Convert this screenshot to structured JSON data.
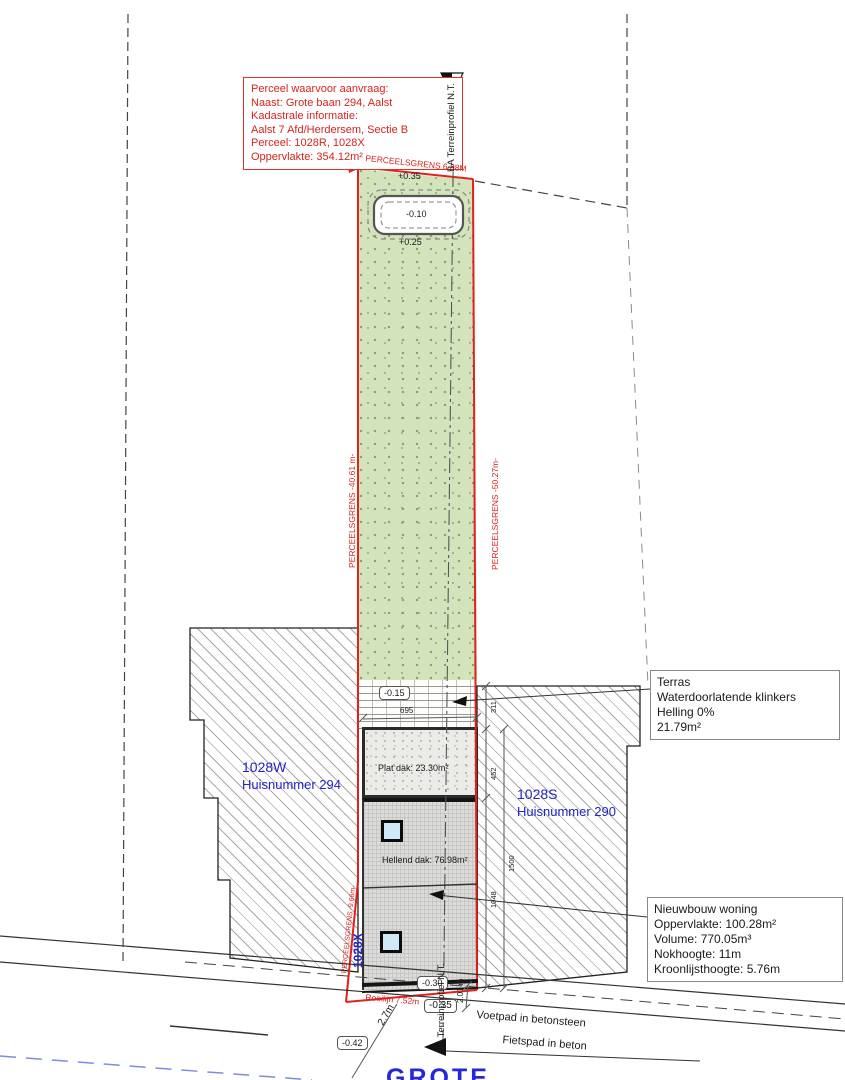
{
  "colors": {
    "boundary_red": "#e3201a",
    "label_blue": "#2222cc",
    "grass_green": "#d3e4bd",
    "street_dash_blue": "#7c8ce0"
  },
  "info_box": {
    "lines": [
      "Perceel waarvoor aanvraag:",
      "Naast: Grote baan 294, Aalst",
      "Kadastrale informatie:",
      "Aalst 7 Afd/Herdersem, Sectie B",
      "Perceel: 1028R, 1028X",
      "Oppervlakte: 354.12m²"
    ]
  },
  "terras_box": {
    "lines": [
      "Terras",
      "Waterdoorlatende klinkers",
      "Helling 0%",
      "21.79m²"
    ]
  },
  "nieuwbouw_box": {
    "lines": [
      "Nieuwbouw woning",
      "Oppervlakte: 100.28m²",
      "Volume: 770.05m³",
      "Nokhoogte: 11m",
      "Kroonlijsthoogte: 5.76m"
    ]
  },
  "boundaries": {
    "top": "PERCEELSGRENS 6.98M",
    "left": "PERCEELSGRENS -40.61 m-",
    "right": "PERCEELSGRENS -50.27m-",
    "bottom_left": "PERCEELSGRENS -9.66m-",
    "rooilijn": "Rooilijn 7.52m"
  },
  "levels": {
    "pool_top": "+0.35",
    "pool": "-0.10",
    "pool_bottom": "+0.25",
    "terras": "-0.15",
    "facade": "-0.30",
    "rooilijn": "-0.35",
    "street": "-0.42"
  },
  "dimensions": {
    "terras_width": "695",
    "terras_depth": "311",
    "plat_depth": "452",
    "hellend_depth": "1048",
    "total_depth": "1500",
    "front_distance": "2.01 m",
    "sidewalk_width": "2.7m"
  },
  "parcels": {
    "left_id": "1028W",
    "left_house": "Huisnummer 294",
    "right_id": "1028S",
    "right_house": "Huisnummer 290",
    "strip_id": "1028X"
  },
  "roofs": {
    "flat": "Plat dak: 23.30m²",
    "sloped": "Hellend dak: 76.98m²"
  },
  "section_marker": {
    "top": "BA Terreinprofiel N.T.",
    "bottom": "BA Terreinprofiel N.T."
  },
  "street": {
    "voetpad": "Voetpad in betonsteen",
    "fietspad": "Fietspad in beton",
    "name": "GROTE"
  }
}
